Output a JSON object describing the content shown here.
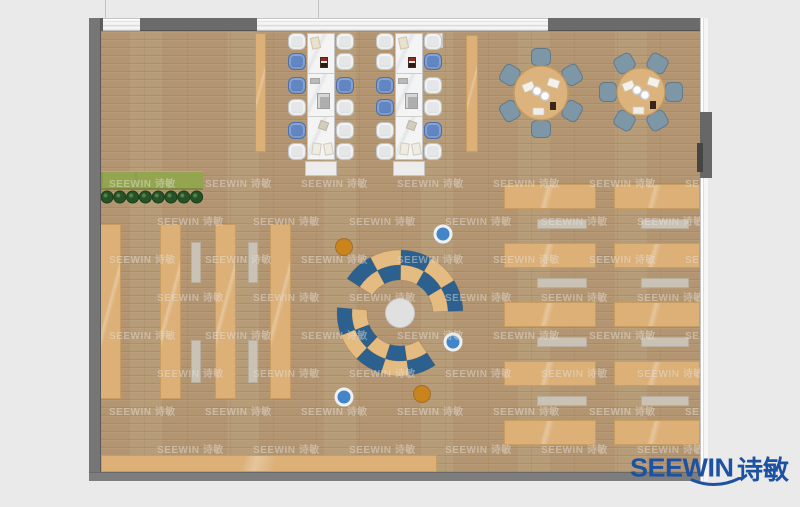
{
  "brand": {
    "logo_text": "SEEWIN",
    "logo_cn": "诗敏",
    "logo_color": "#1d51a1",
    "watermark_text": "SEEWIN 诗敏"
  },
  "palette": {
    "background": "#eaeaea",
    "floor_wood": "#b39671",
    "furniture_wood": "#dcb077",
    "wall_gray": "#6b6b6b",
    "desk_white": "#f4f4f4",
    "chair_white": "#e4e6e7",
    "chair_blue": "#6286c3",
    "chair_slate": "#7e97a7",
    "arc_blue": "#2c618f",
    "arc_tan": "#e4bb80",
    "dot_orange": "#c9841e",
    "dot_blue": "#4286c9",
    "planter_green": "#93a64f",
    "plant_green": "#275227"
  },
  "floorplan": {
    "workstation_banks": [
      {
        "x": 307,
        "chairs_left_x": 288,
        "chairs_right_x": 336,
        "chairs_left": [
          "w",
          "b",
          "b",
          "w",
          "b",
          "w"
        ],
        "chairs_right": [
          "w",
          "w",
          "b",
          "w",
          "w",
          "w"
        ],
        "has_printer": false
      },
      {
        "x": 395,
        "chairs_left_x": 376,
        "chairs_right_x": 424,
        "chairs_left": [
          "w",
          "w",
          "b",
          "b",
          "w",
          "w"
        ],
        "chairs_right": [
          "w",
          "b",
          "w",
          "w",
          "b",
          "w"
        ],
        "has_printer": true
      }
    ],
    "chair_rows_y": [
      33,
      53,
      77,
      99,
      122,
      143
    ],
    "desk_items": [
      {
        "dx": 4,
        "dy": 4,
        "w": 9,
        "h": 12,
        "bg": "#e9e2cb",
        "rot": -12
      },
      {
        "dx": 13,
        "dy": 24,
        "w": 8,
        "h": 11,
        "bg": "#2b1a10",
        "rot": 0,
        "red": true
      },
      {
        "dx": 3,
        "dy": 45,
        "w": 10,
        "h": 6,
        "bg": "#b9b9b9",
        "rot": 0
      },
      {
        "dx": 10,
        "dy": 60,
        "w": 13,
        "h": 16,
        "bg": "#aeaeae",
        "rot": 0,
        "inner": "#d6d6d6"
      },
      {
        "dx": 12,
        "dy": 88,
        "w": 9,
        "h": 9,
        "bg": "#d4ccbc",
        "rot": 20
      },
      {
        "dx": 5,
        "dy": 110,
        "w": 9,
        "h": 12,
        "bg": "#efece2",
        "rot": 8
      },
      {
        "dx": 17,
        "dy": 110,
        "w": 9,
        "h": 12,
        "bg": "#efece2",
        "rot": -10
      }
    ],
    "round_tables": [
      {
        "cx": 541,
        "cy": 93,
        "r": 27,
        "seat_dist": 36,
        "seat_angles": [
          90,
          150,
          210,
          270,
          330,
          30
        ]
      },
      {
        "cx": 641,
        "cy": 92,
        "r": 24,
        "seat_dist": 33,
        "seat_angles": [
          0,
          60,
          120,
          180,
          240,
          300
        ]
      }
    ],
    "shelves": {
      "cols_x": [
        100,
        160,
        215,
        270
      ],
      "y": 224,
      "w": 21,
      "h": 175
    },
    "bench_strips": {
      "cols_x": [
        191,
        248
      ],
      "w": 10,
      "segments": [
        [
          242,
          41
        ],
        [
          340,
          43
        ]
      ]
    },
    "reading_area": {
      "table_cols": [
        [
          504,
          92
        ],
        [
          614,
          86
        ]
      ],
      "table_rows_y": [
        184,
        243,
        302,
        361,
        420
      ],
      "table_h": 25,
      "bench_cols": [
        [
          537,
          50
        ],
        [
          641,
          48
        ]
      ],
      "bench_rows_y": [
        219,
        278,
        337,
        396
      ],
      "bench_h": 10
    },
    "planter": {
      "x": 101,
      "y": 171,
      "w": 102,
      "h": 19,
      "plant_count": 8,
      "plants_y": 197
    },
    "lounge": {
      "cx": 400,
      "cy": 313,
      "inner_circle_r": 14.5,
      "radii": [
        33,
        48,
        63
      ],
      "arcs": [
        {
          "start": 147,
          "end": 2,
          "outer": [
            "b",
            "t",
            "b",
            "t",
            "b"
          ],
          "inner": [
            "t",
            "b",
            "t",
            "b",
            "t"
          ]
        },
        {
          "start": 175,
          "end": 304,
          "outer": [
            "b",
            "t",
            "b",
            "t",
            "b"
          ],
          "inner": [
            "t",
            "b",
            "t",
            "b",
            "t"
          ]
        }
      ],
      "dots": [
        {
          "x": 344,
          "y": 247,
          "c": "orange"
        },
        {
          "x": 422,
          "y": 394,
          "c": "orange"
        },
        {
          "x": 443,
          "y": 234,
          "c": "blue"
        },
        {
          "x": 453,
          "y": 342,
          "c": "blue"
        },
        {
          "x": 344,
          "y": 397,
          "c": "blue"
        }
      ]
    }
  }
}
